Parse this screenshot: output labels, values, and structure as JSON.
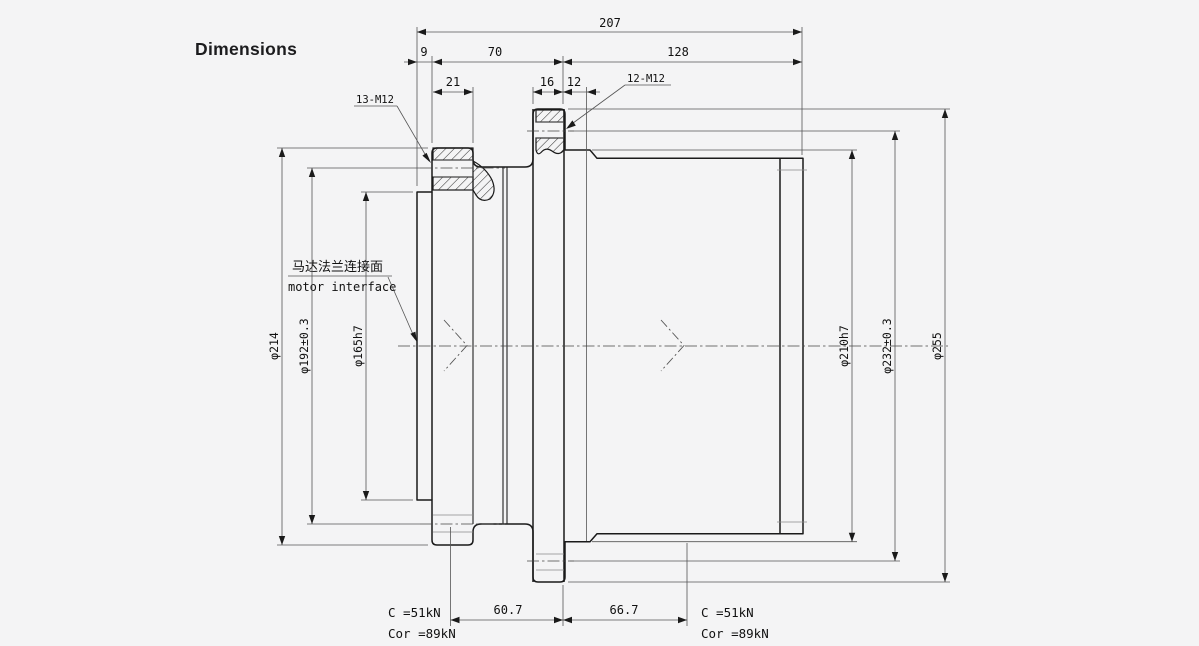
{
  "title": "Dimensions",
  "colors": {
    "background": "#f4f4f5",
    "line": "#1a1a1a",
    "thin_line": "#555555"
  },
  "top_dimensions": {
    "total": "207",
    "pilot_width": "9",
    "left_section": "70",
    "right_section": "128",
    "left_flange_width": "21",
    "mid_flange_width": "16",
    "spigot_width": "12"
  },
  "thread_labels": {
    "left": "13-M12",
    "right": "12-M12"
  },
  "motor_interface": {
    "zh": "马达法兰连接面",
    "en": "motor interface"
  },
  "diameters": {
    "left": [
      "φ214",
      "φ192±0.3",
      "φ165h7"
    ],
    "right": [
      "φ210h7",
      "φ232±0.3",
      "φ255"
    ]
  },
  "bottom_dimensions": {
    "left_span": "60.7",
    "right_span": "66.7"
  },
  "load_ratings": {
    "left": {
      "c": "C =51kN",
      "cor": "Cor =89kN"
    },
    "right": {
      "c": "C =51kN",
      "cor": "Cor =89kN"
    }
  }
}
